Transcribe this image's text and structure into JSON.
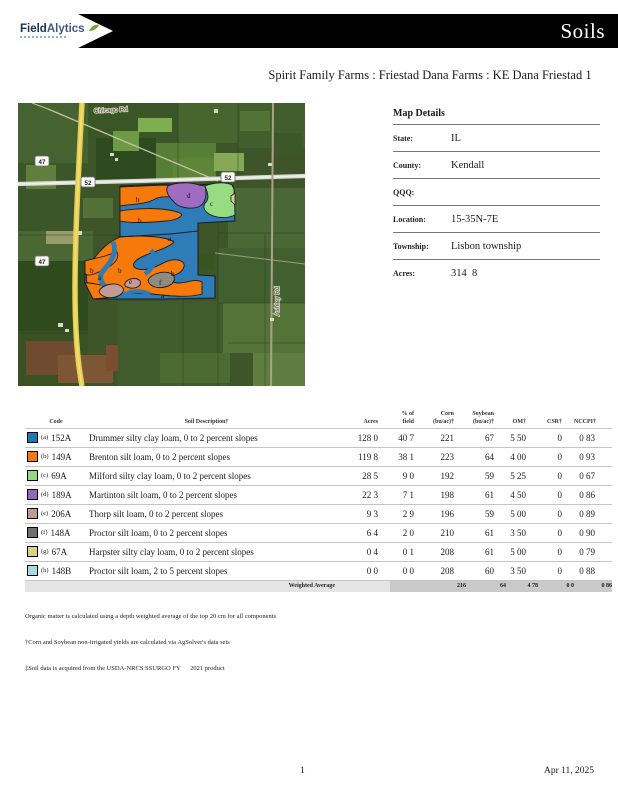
{
  "header": {
    "logo_part1": "Field",
    "logo_part2": "Alytics",
    "banner_title": "Soils"
  },
  "title": "Spirit Family Farms : Friestad Dana Farms : KE Dana Friestad 1",
  "map": {
    "shield_47": "47",
    "shield_52": "52",
    "label_chicago": "Chicago Rd",
    "label_ashley": "Ashley Rd",
    "letters": [
      "b",
      "b",
      "d",
      "c",
      "a",
      "b",
      "a",
      "b",
      "e",
      "f",
      "b",
      "a"
    ]
  },
  "map_details": {
    "title": "Map Details",
    "rows": [
      {
        "label": "State:",
        "value": "IL"
      },
      {
        "label": "County:",
        "value": "Kendall"
      },
      {
        "label": "QQQ:",
        "value": ""
      },
      {
        "label": "Location:",
        "value": "15-35N-7E"
      },
      {
        "label": "Township:",
        "value": "Lisbon township"
      },
      {
        "label": "Acres:",
        "value": "314  8"
      }
    ]
  },
  "soil_table": {
    "headers": {
      "code": "Code",
      "description": "Soil Description†",
      "acres": "Acres",
      "pct1": "% of",
      "pct2": "field",
      "corn1": "Corn",
      "corn2": "(bu/ac)†",
      "soy1": "Soybean",
      "soy2": "(bu/ac)†",
      "om": "OM†",
      "csr": "CSR†",
      "nccpi": "NCCPI†"
    },
    "rows": [
      {
        "letter": "(a)",
        "code": "152A",
        "color": "#1F77B4",
        "description": "Drummer silty clay loam, 0 to 2 percent slopes",
        "acres": "128 0",
        "pct": "40 7",
        "corn": "221",
        "soybean": "67",
        "om": "5 50",
        "csr": "0",
        "nccpi": "0 83"
      },
      {
        "letter": "(b)",
        "code": "149A",
        "color": "#F5790B",
        "description": "Brenton silt loam, 0 to 2 percent slopes",
        "acres": "119 8",
        "pct": "38 1",
        "corn": "223",
        "soybean": "64",
        "om": "4 00",
        "csr": "0",
        "nccpi": "0 93"
      },
      {
        "letter": "(c)",
        "code": "69A",
        "color": "#8FDC7F",
        "description": "Milford silty clay loam, 0 to 2 percent slopes",
        "acres": "28 5",
        "pct": "9 0",
        "corn": "192",
        "soybean": "59",
        "om": "5 25",
        "csr": "0",
        "nccpi": "0 67"
      },
      {
        "letter": "(d)",
        "code": "189A",
        "color": "#9467BD",
        "description": "Martinton silt loam, 0 to 2 percent slopes",
        "acres": "22 3",
        "pct": "7 1",
        "corn": "198",
        "soybean": "61",
        "om": "4 50",
        "csr": "0",
        "nccpi": "0 86"
      },
      {
        "letter": "(e)",
        "code": "206A",
        "color": "#C29B94",
        "description": "Thorp silt loam, 0 to 2 percent slopes",
        "acres": "9 3",
        "pct": "2 9",
        "corn": "196",
        "soybean": "59",
        "om": "5 00",
        "csr": "0",
        "nccpi": "0 89"
      },
      {
        "letter": "(f)",
        "code": "148A",
        "color": "#6F6F6F",
        "description": "Proctor silt loam, 0 to 2 percent slopes",
        "acres": "6 4",
        "pct": "2 0",
        "corn": "210",
        "soybean": "61",
        "om": "3 50",
        "csr": "0",
        "nccpi": "0 90"
      },
      {
        "letter": "(g)",
        "code": "67A",
        "color": "#D9D388",
        "description": "Harpster silty clay loam, 0 to 2 percent slopes",
        "acres": "0 4",
        "pct": "0 1",
        "corn": "208",
        "soybean": "61",
        "om": "5 00",
        "csr": "0",
        "nccpi": "0 79"
      },
      {
        "letter": "(h)",
        "code": "148B",
        "color": "#A8DCE4",
        "description": "Proctor silt loam, 2 to 5 percent slopes",
        "acres": "0 0",
        "pct": "0 0",
        "corn": "208",
        "soybean": "60",
        "om": "3 50",
        "csr": "0",
        "nccpi": "0 88"
      }
    ],
    "weighted": {
      "label": "Weighted Average",
      "corn": "216",
      "soybean": "64",
      "om": "4 78",
      "csr": "0 0",
      "nccpi": "0 86"
    }
  },
  "footnotes": [
    "Organic matter is calculated using a depth weighted average of the top 20 cm for all components",
    "†Corn and Soybean non-irrigated yields are calculated via AgSolver's data sets",
    "‡Soil data is acquired from the USDA-NRCS SSURGO FY      2021 product"
  ],
  "footer": {
    "page_number": "1",
    "date": "Apr 11, 2025"
  },
  "colors": {
    "blue": "#2E7CB8",
    "orange": "#F5790B",
    "green": "#97DC82",
    "purple": "#A06CC2",
    "pink": "#C29B94",
    "gray": "#8E8B80",
    "khaki": "#D9D388",
    "field_outline": "#1C1C1C"
  }
}
